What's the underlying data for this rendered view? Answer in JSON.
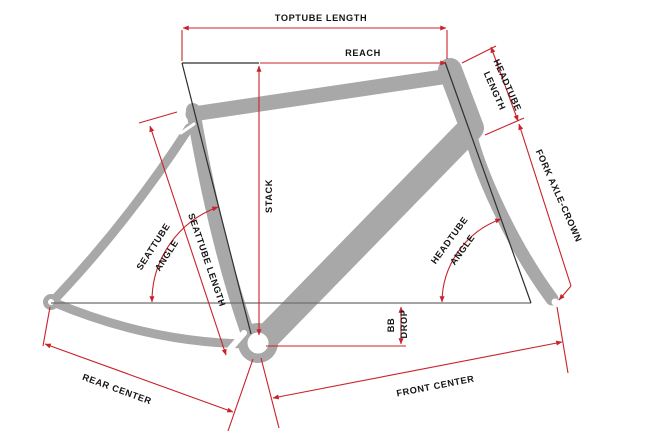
{
  "diagram": {
    "kind": "bicycle-frame-geometry",
    "labels": {
      "toptube_length": "TOPTUBE LENGTH",
      "reach": "REACH",
      "headtube_length_line1": "HEADTUBE",
      "headtube_length_line2": "LENGTH",
      "fork_axle_crown": "FORK AXLE-CROWN",
      "stack": "STACK",
      "seattube_angle_line1": "SEATTUBE",
      "seattube_angle_line2": "ANGLE",
      "seattube_length": "SEATTUBE LENGTH",
      "headtube_angle_line1": "HEADTUBE",
      "headtube_angle_line2": "ANGLE",
      "bb_drop_line1": "BB",
      "bb_drop_line2": "DROP",
      "rear_center": "REAR CENTER",
      "front_center": "FRONT CENTER"
    },
    "colors": {
      "dimension_red": "#c8222b",
      "frame_gray": "#a8a8a8",
      "axis_dark": "#2e2e2e",
      "axle_line": "#6e6e6e",
      "text": "#141414",
      "background": "#ffffff"
    }
  }
}
